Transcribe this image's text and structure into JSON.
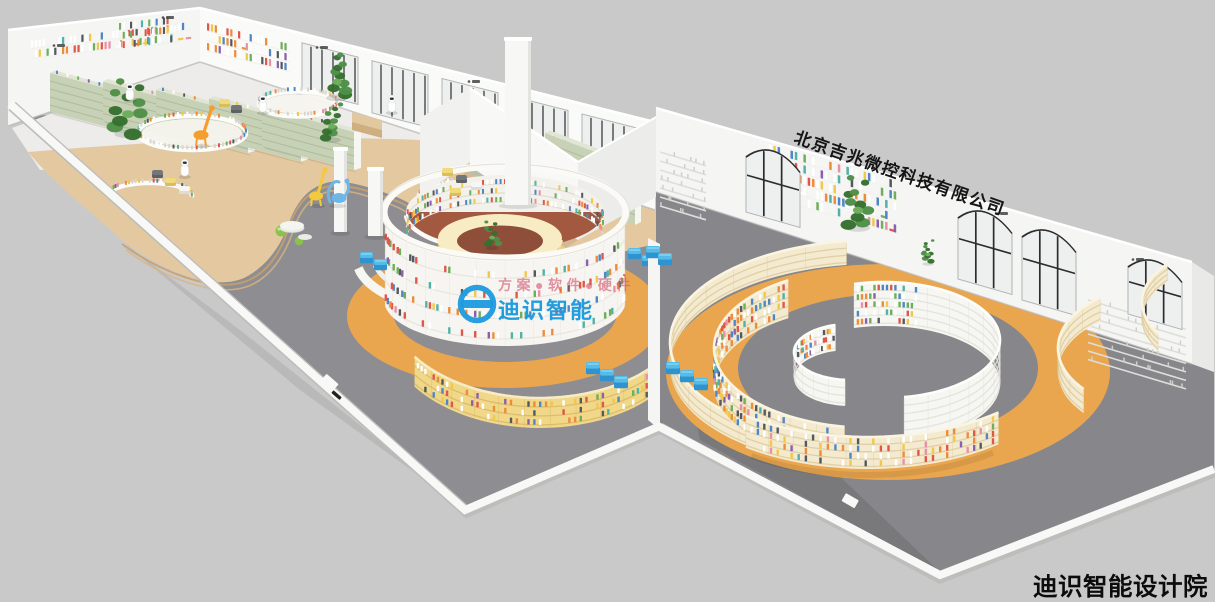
{
  "watermarks": {
    "company_diagonal": "北京吉兆微控科技有限公司",
    "brand_tagline": "方案●软件●硬件",
    "brand_center": "迪识智能",
    "studio_bottom_right": "迪识智能设计院"
  },
  "colors": {
    "background": "#c9c9c9",
    "floor_gray": "#8e8e92",
    "floor_gray_right": "#87878b",
    "floor_dark": "#5a5a5e",
    "wood": "#e4c9a0",
    "wood_edge": "#c8a06b",
    "wood_edge2": "#d9b57f",
    "white_floor": "#edecea",
    "wall_white": "#f5f5f3",
    "wall_shade": "#ececea",
    "wall_bright": "#fafaf8",
    "wall_base_shadow": "#b5b5b3",
    "green_shelf": "#c7d1b6",
    "green_shelf_top": "#e0e6d3",
    "green_shelf_line": "#afbb9e",
    "cream": "#f3ead0",
    "cream_line": "#ddcb9e",
    "yellow_shelf": "#f1d788",
    "yellow_line": "#d8b86a",
    "yellow_top": "#f8ecc4",
    "orange_ring": "#eaa64e",
    "maroon": "#a2593f",
    "maroon_dark": "#8f4e3a",
    "white_shelf": "#f6f6f2",
    "white_shelf_line": "#e2e0d8",
    "window_glass": "#eef0f0",
    "window_frame": "#2d2d2f",
    "window_trim": "#b0b4b4",
    "seat_blue": "#55bce8",
    "seat_blue_dark": "#2f93cf",
    "seat_blue_light": "#86d2f2",
    "plant": "#4e8f47",
    "plant_dark": "#36702f",
    "stool_yellow": "#f2d979",
    "stool_yellow_dark": "#d9bd5e",
    "stool_gray": "#73767a",
    "stool_gray_dark": "#5d6064",
    "stool_white": "#f6f6f4",
    "stool_white_dark": "#dcdcd8",
    "giraffe_orange": "#f59d2e",
    "giraffe_yellow": "#f5c93e",
    "dino_blue": "#6db6e8",
    "ball_green": "#8bc34a",
    "stone": "#ebebe8",
    "robot_white": "#fdfdfd",
    "desk_tan": "#e2c89e",
    "desk_tan_dark": "#cfae80",
    "watermark_blue": "#1b9ade",
    "watermark_pink": "#d4566e",
    "watermark_black": "#151515",
    "studio_black": "#0c0c0c"
  },
  "book_palette": [
    {
      "c": "#ffffff",
      "w": 26
    },
    {
      "c": "#e0574a",
      "w": 12
    },
    {
      "c": "#ee8c3a",
      "w": 13
    },
    {
      "c": "#f2c84b",
      "w": 10
    },
    {
      "c": "#4f86c6",
      "w": 9
    },
    {
      "c": "#6fae5c",
      "w": 8
    },
    {
      "c": "#8a5fb0",
      "w": 4
    },
    {
      "c": "#54595f",
      "w": 8
    },
    {
      "c": "#e791a8",
      "w": 5
    },
    {
      "c": "#52b2a8",
      "w": 5
    }
  ]
}
